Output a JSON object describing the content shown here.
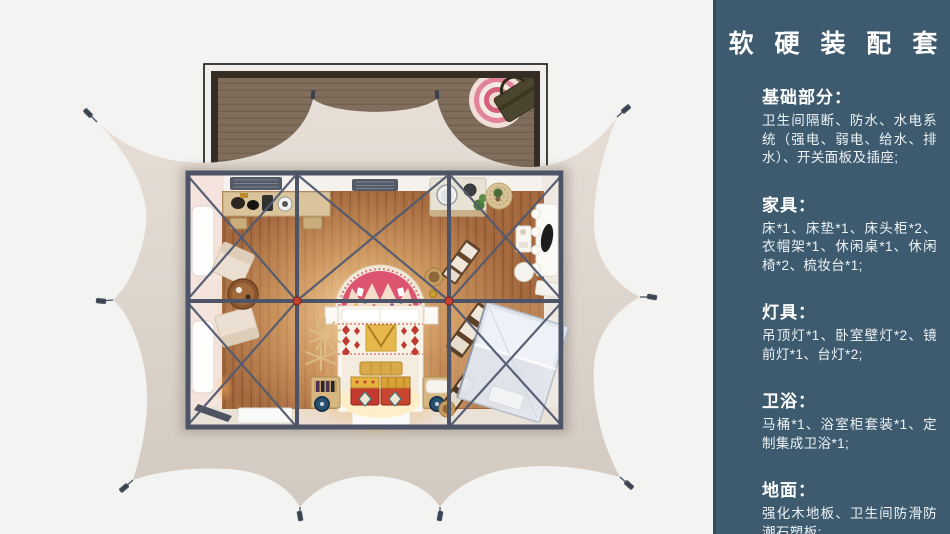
{
  "page": {
    "background": "#f3f3f2"
  },
  "sidebar": {
    "background": "#3d5a6e",
    "text_color": "#ffffff",
    "title": "软 硬 装 配 套",
    "sections": [
      {
        "heading": "基础部分：",
        "body": "卫生间隔断、防水、水电系统（强电、弱电、给水、排水）、开关面板及插座;"
      },
      {
        "heading": "家具：",
        "body": "床*1、床垫*1、床头柜*2、衣帽架*1、休闲桌*1、休闲椅*2、梳妆台*1;"
      },
      {
        "heading": "灯具：",
        "body": "吊顶灯*1、卧室壁灯*2、镜前灯*1、台灯*2;"
      },
      {
        "heading": "卫浴：",
        "body": "马桶*1、浴室柜套装*1、定制集成卫浴*1;"
      },
      {
        "heading": "地面：",
        "body": "强化木地板、卫生间防滑防潮石塑板;"
      }
    ]
  },
  "floorplan": {
    "colors": {
      "tent_canvas": "#ddd5cc",
      "deck_wood": "#806d5b",
      "steel_frame": "#4d5468",
      "joint_accent_red": "#c44134",
      "floor_wood": "#a4693f",
      "bed_linen": "#faf7f0",
      "headboard_rug_pink": "#dc5470",
      "chest_red": "#c23a2e",
      "bath_glass": "#e2e7ef"
    }
  }
}
